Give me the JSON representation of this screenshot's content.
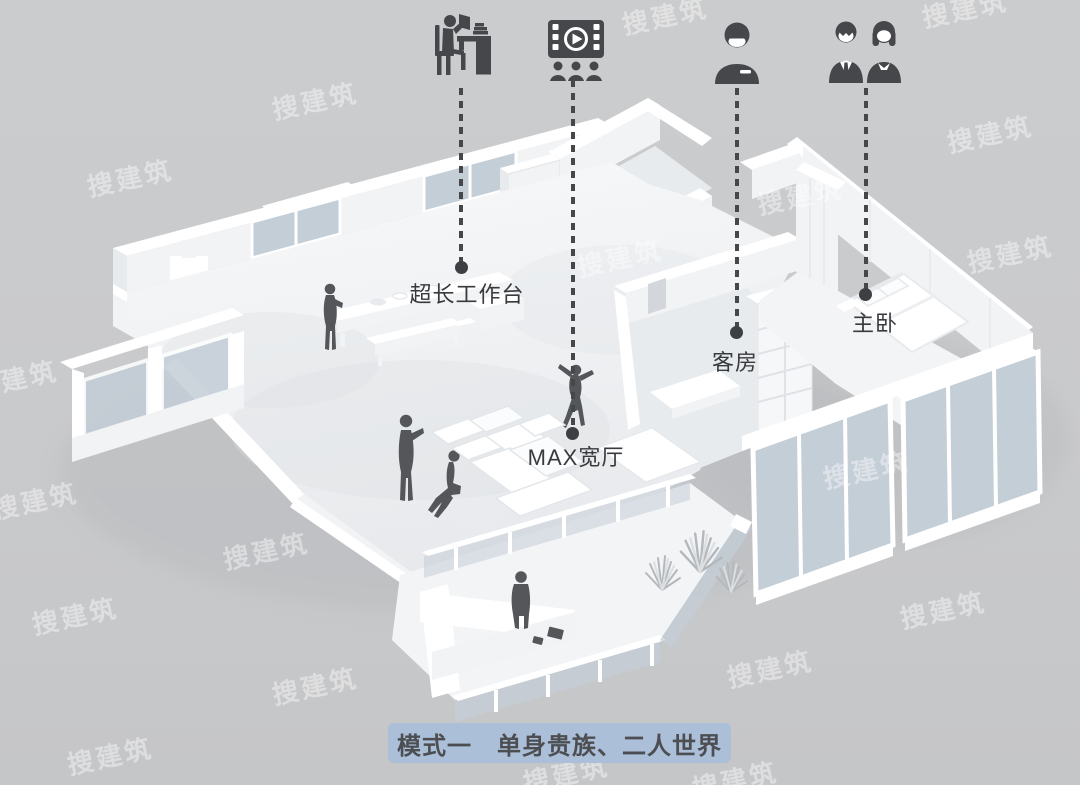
{
  "annotations": [
    {
      "icon": "work-desk-icon",
      "label": "超长工作台"
    },
    {
      "icon": "home-cinema-icon",
      "label": "MAX宽厅"
    },
    {
      "icon": "single-person-icon",
      "label": "客房"
    },
    {
      "icon": "couple-icon",
      "label": "主卧"
    }
  ],
  "caption": {
    "text": "模式一　单身贵族、二人世界"
  },
  "watermark": {
    "text": "搜建筑"
  },
  "colors": {
    "background": "#c9cacc",
    "ink": "#46474b",
    "label_text": "#393a3d",
    "badge_background": "#abbfd8",
    "badge_text": "#4c4e52",
    "watermark": "rgba(255,255,255,0.42)",
    "glass": "#c4ced7",
    "wall": "#ffffff",
    "floor": "#f3f4f6",
    "shadow": "#dcdfe2",
    "figure": "#55565a"
  }
}
